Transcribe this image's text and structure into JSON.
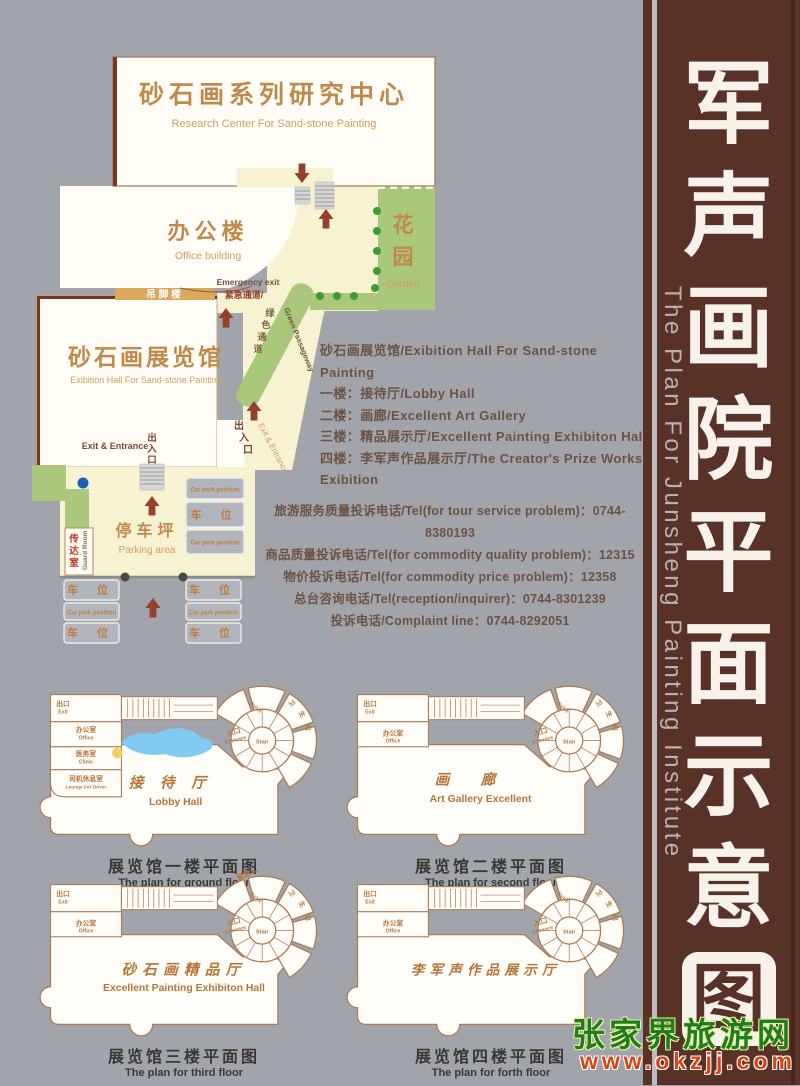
{
  "site": {
    "research_center": {
      "cn": "砂石画系列研究中心",
      "en": "Research Center For Sand-stone Painting"
    },
    "office": {
      "cn": "办公楼",
      "en": "Office building"
    },
    "garden": {
      "cn": [
        "花",
        "园"
      ],
      "en": "Garden"
    },
    "diaojiaolou": "吊脚楼",
    "emergency": {
      "en": "Emergency exit",
      "cn": "紧急通道/"
    },
    "exhibition": {
      "cn": "砂石画展览馆",
      "en": "Exibition Hall For Sand-stone Painting"
    },
    "green_passage": {
      "cn": [
        "绿",
        "色",
        "通",
        "道"
      ],
      "en": "Green Passageway"
    },
    "side_exit": {
      "cn": [
        "出",
        "入",
        "口"
      ],
      "en": "Exit & Entrance"
    },
    "main_exit": {
      "cn": [
        "出",
        "入",
        "口"
      ],
      "en": "Exit & Entrance"
    },
    "parking": {
      "cn": "停车坪",
      "en": "Parking area"
    },
    "guard": {
      "cn": [
        "传",
        "达",
        "室"
      ],
      "en": "Guard Room"
    },
    "car_cn": "车 位",
    "car_en": "Car park position"
  },
  "floors_info": {
    "lines": [
      "砂石画展览馆/Exibition Hall For Sand-stone Painting",
      "一楼：接待厅/Lobby Hall",
      "二楼：画廊/Excellent Art Gallery",
      "三楼：精品展示厅/Excellent Painting Exhibiton Hall",
      "四楼：李军声作品展示厅/The Creator's Prize Works Exibition"
    ]
  },
  "phones": {
    "lines": [
      "旅游服务质量投诉电话/Tel(for tour service problem)：0744-8380193",
      "商品质量投诉电话/Tel(for commodity quality problem)：12315",
      "物价投诉电话/Tel(for commodity price problem)：12358",
      "总台咨询电话/Tel(reception/inquirer)：0744-8301239",
      "投诉电话/Complaint line：0744-8292051"
    ]
  },
  "plan_common": {
    "exit_cn": "出口",
    "exit_en": "Exit",
    "office_cn": "办公室",
    "office_en": "Office",
    "entrance_cn": "入口",
    "entrance_en": "Entrance",
    "stair": "Stair",
    "toilet_en": "Toilet",
    "toilet_cn": [
      "卫",
      "生",
      "间"
    ]
  },
  "plans": [
    {
      "hall_cn": "接待厅",
      "hall_en": "Lobby Hall",
      "clinic_cn": "医务室",
      "clinic_en": "Clinic",
      "lounge_cn": "司机休息室",
      "lounge_en": "Lounge For Driver",
      "caption_cn": "展览馆一楼平面图",
      "caption_en": "The plan for ground floor"
    },
    {
      "hall_cn": "画廊",
      "hall_en": "Art Gallery Excellent",
      "caption_cn": "展览馆二楼平面图",
      "caption_en": "The plan for second floor"
    },
    {
      "hall_cn": "砂石画精品厅",
      "hall_en": "Excellent Painting Exhibiton Hall",
      "emergency_exit": "紧急出口",
      "caption_cn": "展览馆三楼平面图",
      "caption_en": "The plan for third floor"
    },
    {
      "hall_cn": "李军声作品展示厅",
      "hall_en": "",
      "caption_cn": "展览馆四楼平面图",
      "caption_en": "The plan for forth floor"
    }
  ],
  "sidebar": {
    "chars": [
      "军",
      "声",
      "画",
      "院",
      "平",
      "面",
      "示",
      "意",
      "图"
    ],
    "en": "The Plan For Junsheng Painting Institute"
  },
  "watermark": {
    "cn": "张家界旅游网",
    "url": "www.okzjj.com"
  },
  "colors": {
    "background": "#a1a4ab",
    "sidebar_brown": "#583226",
    "building_white": "#fffdf6",
    "path_yellow": "#f6f2d2",
    "garden_green": "#a9c87c",
    "dot_green": "#3f9c35",
    "arrow_maroon": "#95402c",
    "label_tan": "#c18a4d",
    "info_text": "#6d5244",
    "watermark_green": "#1f7d1f",
    "watermark_red": "#d84312",
    "pond_blue": "#82cbf0"
  }
}
